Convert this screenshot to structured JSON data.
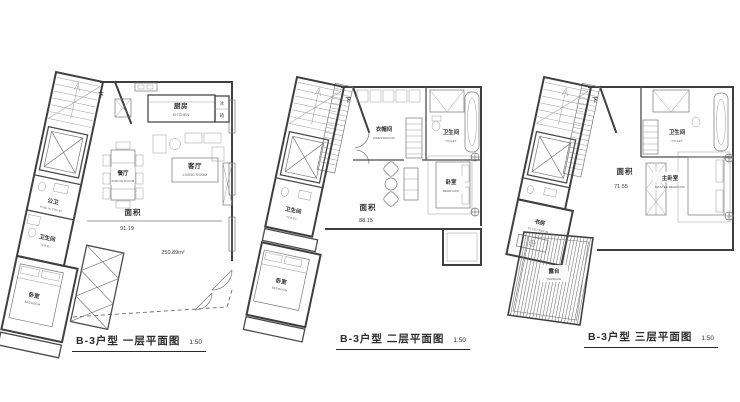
{
  "colors": {
    "paper": "#ffffff",
    "wall_line": "#3f3f3f",
    "detail_line": "#777777",
    "text": "#2e2e2e"
  },
  "plans": [
    {
      "title": "B-3户型  一层平面图",
      "scale": "1:50",
      "stair_label": "下",
      "area_label": "面积",
      "area_value": "91.19",
      "total_area": "250.89m²",
      "rooms": {
        "kitchen_zh": "厨房",
        "kitchen_en": "KITCHEN",
        "fridge_top": "冰",
        "fridge_bottom": "箱",
        "dining_zh": "餐厅",
        "dining_en": "DINING ROOM",
        "living_zh": "客厅",
        "living_en": "LIVING ROOM",
        "public_toilet_zh": "公卫",
        "public_toilet_en": "PUBLIC TOILET",
        "toilet_zh": "卫生间",
        "toilet_en": "TOILET",
        "bedroom_zh": "卧室",
        "bedroom_en": "BEDROOM"
      }
    },
    {
      "title": "B-3户型  二层平面图",
      "scale": "1:50",
      "stair_label": "下",
      "area_label": "面积",
      "area_value": "88.15",
      "rooms": {
        "dressroom_zh": "衣帽间",
        "dressroom_en": "DRESSROOM",
        "toilet_top_zh": "卫生间",
        "toilet_top_en": "TOILET",
        "bedroom_right_zh": "卧室",
        "bedroom_right_en": "BEDROOM",
        "toilet_left_zh": "卫生间",
        "toilet_left_en": "TOILET",
        "bedroom_bottom_zh": "卧室",
        "bedroom_bottom_en": "BEDROOM"
      }
    },
    {
      "title": "B-3户型  三层平面图",
      "scale": "1:50",
      "stair_label": "下",
      "area_label": "面积",
      "area_value": "71.55",
      "rooms": {
        "toilet_zh": "卫生间",
        "toilet_en": "TOILET",
        "master_zh": "主卧室",
        "master_en": "MASTER BEDROOM",
        "study_zh": "书房",
        "study_en": "STUDY ROOM",
        "terrace_zh": "露台",
        "terrace_en": "TERRACE"
      }
    }
  ]
}
